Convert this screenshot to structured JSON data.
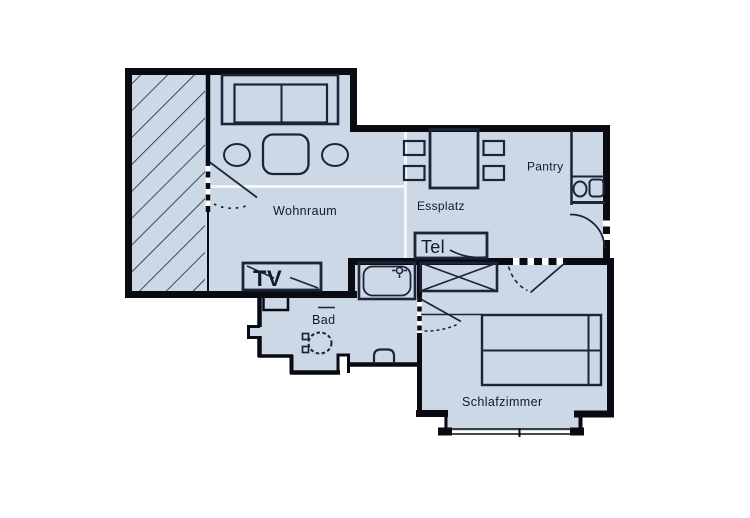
{
  "plan": {
    "rooms": {
      "wohnraum": "Wohnraum",
      "essplatz": "Essplatz",
      "pantry": "Pantry",
      "bad": "Bad",
      "schlafzimmer": "Schlafzimmer"
    },
    "fixtures": {
      "tv": "TV",
      "tel": "Tel"
    },
    "colors": {
      "floor": "#ccd8e6",
      "wall": "#0a0a12",
      "line": "#1c2438",
      "text": "#13192b",
      "background": "#ffffff"
    }
  }
}
